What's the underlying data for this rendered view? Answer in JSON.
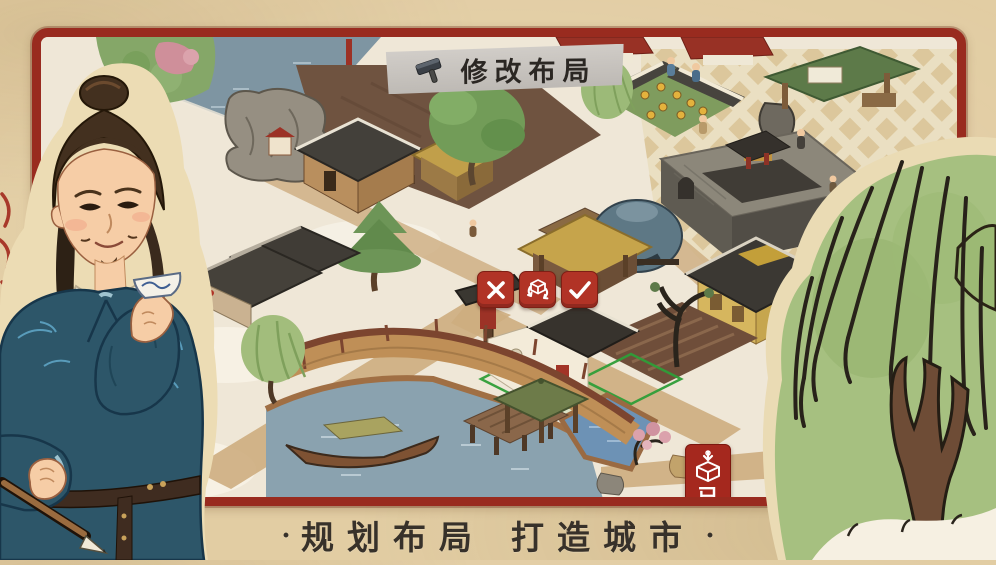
{
  "app": {
    "name": "jiangnan-city-builder",
    "mode": "layout-edit"
  },
  "edit_banner": {
    "icon": "hammer-icon",
    "label": "修改布局"
  },
  "edit_actions": {
    "cancel": {
      "icon": "x-icon"
    },
    "rotate": {
      "icon": "rotate-cube-icon"
    },
    "confirm": {
      "icon": "check-icon"
    },
    "button_color": "#b13326"
  },
  "store_button": {
    "icon": "store-box-icon",
    "partial_text": "已",
    "color": "#a5281e"
  },
  "tagline": {
    "prefix_dot": "·",
    "part1": "规划布局",
    "part2": "打造城市",
    "suffix_dot": "·"
  },
  "scene": {
    "description": "isometric snowy canal-town with bridge, kiln, walled compound, sunflower yard, plaza, selected house on green placement grid",
    "selected_building": "white-walled house with dark tile roof on green grid",
    "colors": {
      "frame_red": "#992b1f",
      "parchment": "#e2cda3",
      "snow_ground": "#efe7d7",
      "water": "#7e95a2",
      "pond": "#8aa2af",
      "grid_green": "#2f9e38",
      "roof_dark": "#3b3833",
      "plaza_tile": "#dcc79c",
      "willow_green": "#a6c080"
    }
  }
}
